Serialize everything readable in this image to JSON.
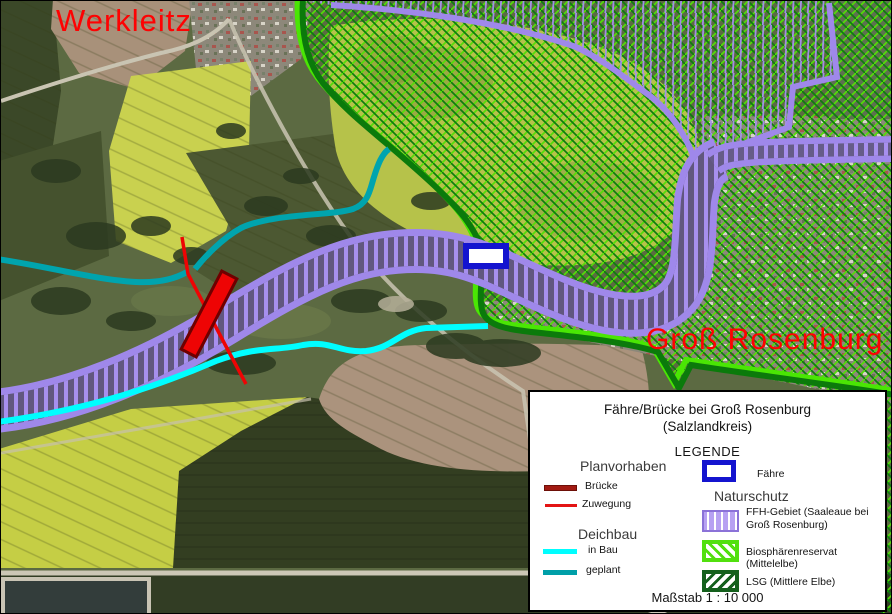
{
  "map": {
    "labels": {
      "werkleitz": "Werkleitz",
      "gross_rosenburg": "Groß Rosenburg"
    },
    "colors": {
      "place_label_red": "#fe0202",
      "ffh_purple": "#9f88ea",
      "biosphere_bright_green": "#4ae604",
      "lsg_dark_green": "#0b7a0b",
      "dike_in_bau_cyan": "#00feff",
      "dike_geplant_teal": "#00a4ae",
      "bridge_red": "#ee0404",
      "zuwegung_red": "#e31414",
      "ferry_blue": "#1414cf"
    }
  },
  "legend": {
    "title_line1": "Fähre/Brücke bei Groß Rosenburg",
    "title_line2": "(Salzlandkreis)",
    "heading": "LEGENDE",
    "planvorhaben": {
      "heading": "Planvorhaben",
      "bruecke": "Brücke",
      "zuwegung": "Zuwegung"
    },
    "deichbau": {
      "heading": "Deichbau",
      "in_bau": "in Bau",
      "geplant": "geplant"
    },
    "faehre_label": "Fähre",
    "naturschutz": {
      "heading": "Naturschutz",
      "ffh": "FFH-Gebiet (Saaleaue bei Groß Rosenburg)",
      "biosphaere": "Biosphärenreservat (Mittelelbe)",
      "lsg": "LSG (Mittlere Elbe)"
    },
    "massstab": "Maßstab 1 : 10 000"
  }
}
